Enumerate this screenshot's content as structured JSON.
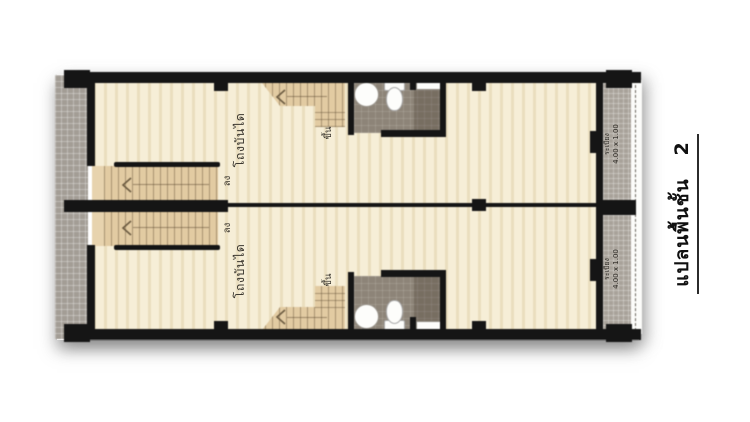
{
  "title": {
    "text": "แปลนพื้นชั้น",
    "number": "2"
  },
  "units": [
    {
      "name": "unit-upper",
      "hall_label": "โถงบันได",
      "down_label": "ลง",
      "up_label": "ขึ้น",
      "balcony_label": "ระเบียง",
      "balcony_size": "4.00 x 1.00"
    },
    {
      "name": "unit-lower",
      "hall_label": "โถงบันได",
      "down_label": "ลง",
      "up_label": "ขึ้น",
      "balcony_label": "ระเบียง",
      "balcony_size": "4.00 x 1.00"
    }
  ],
  "colors": {
    "wall": "#151515",
    "unit_floor": "#f6eed7",
    "stair": "#e2cba2",
    "walkway_tile": "#a39d95",
    "balcony_tile": "#a8a29a",
    "bathroom_floor": "#8d8478",
    "shower_floor": "#7c7467",
    "label_text": "#3b372f",
    "title_text": "#101010"
  }
}
